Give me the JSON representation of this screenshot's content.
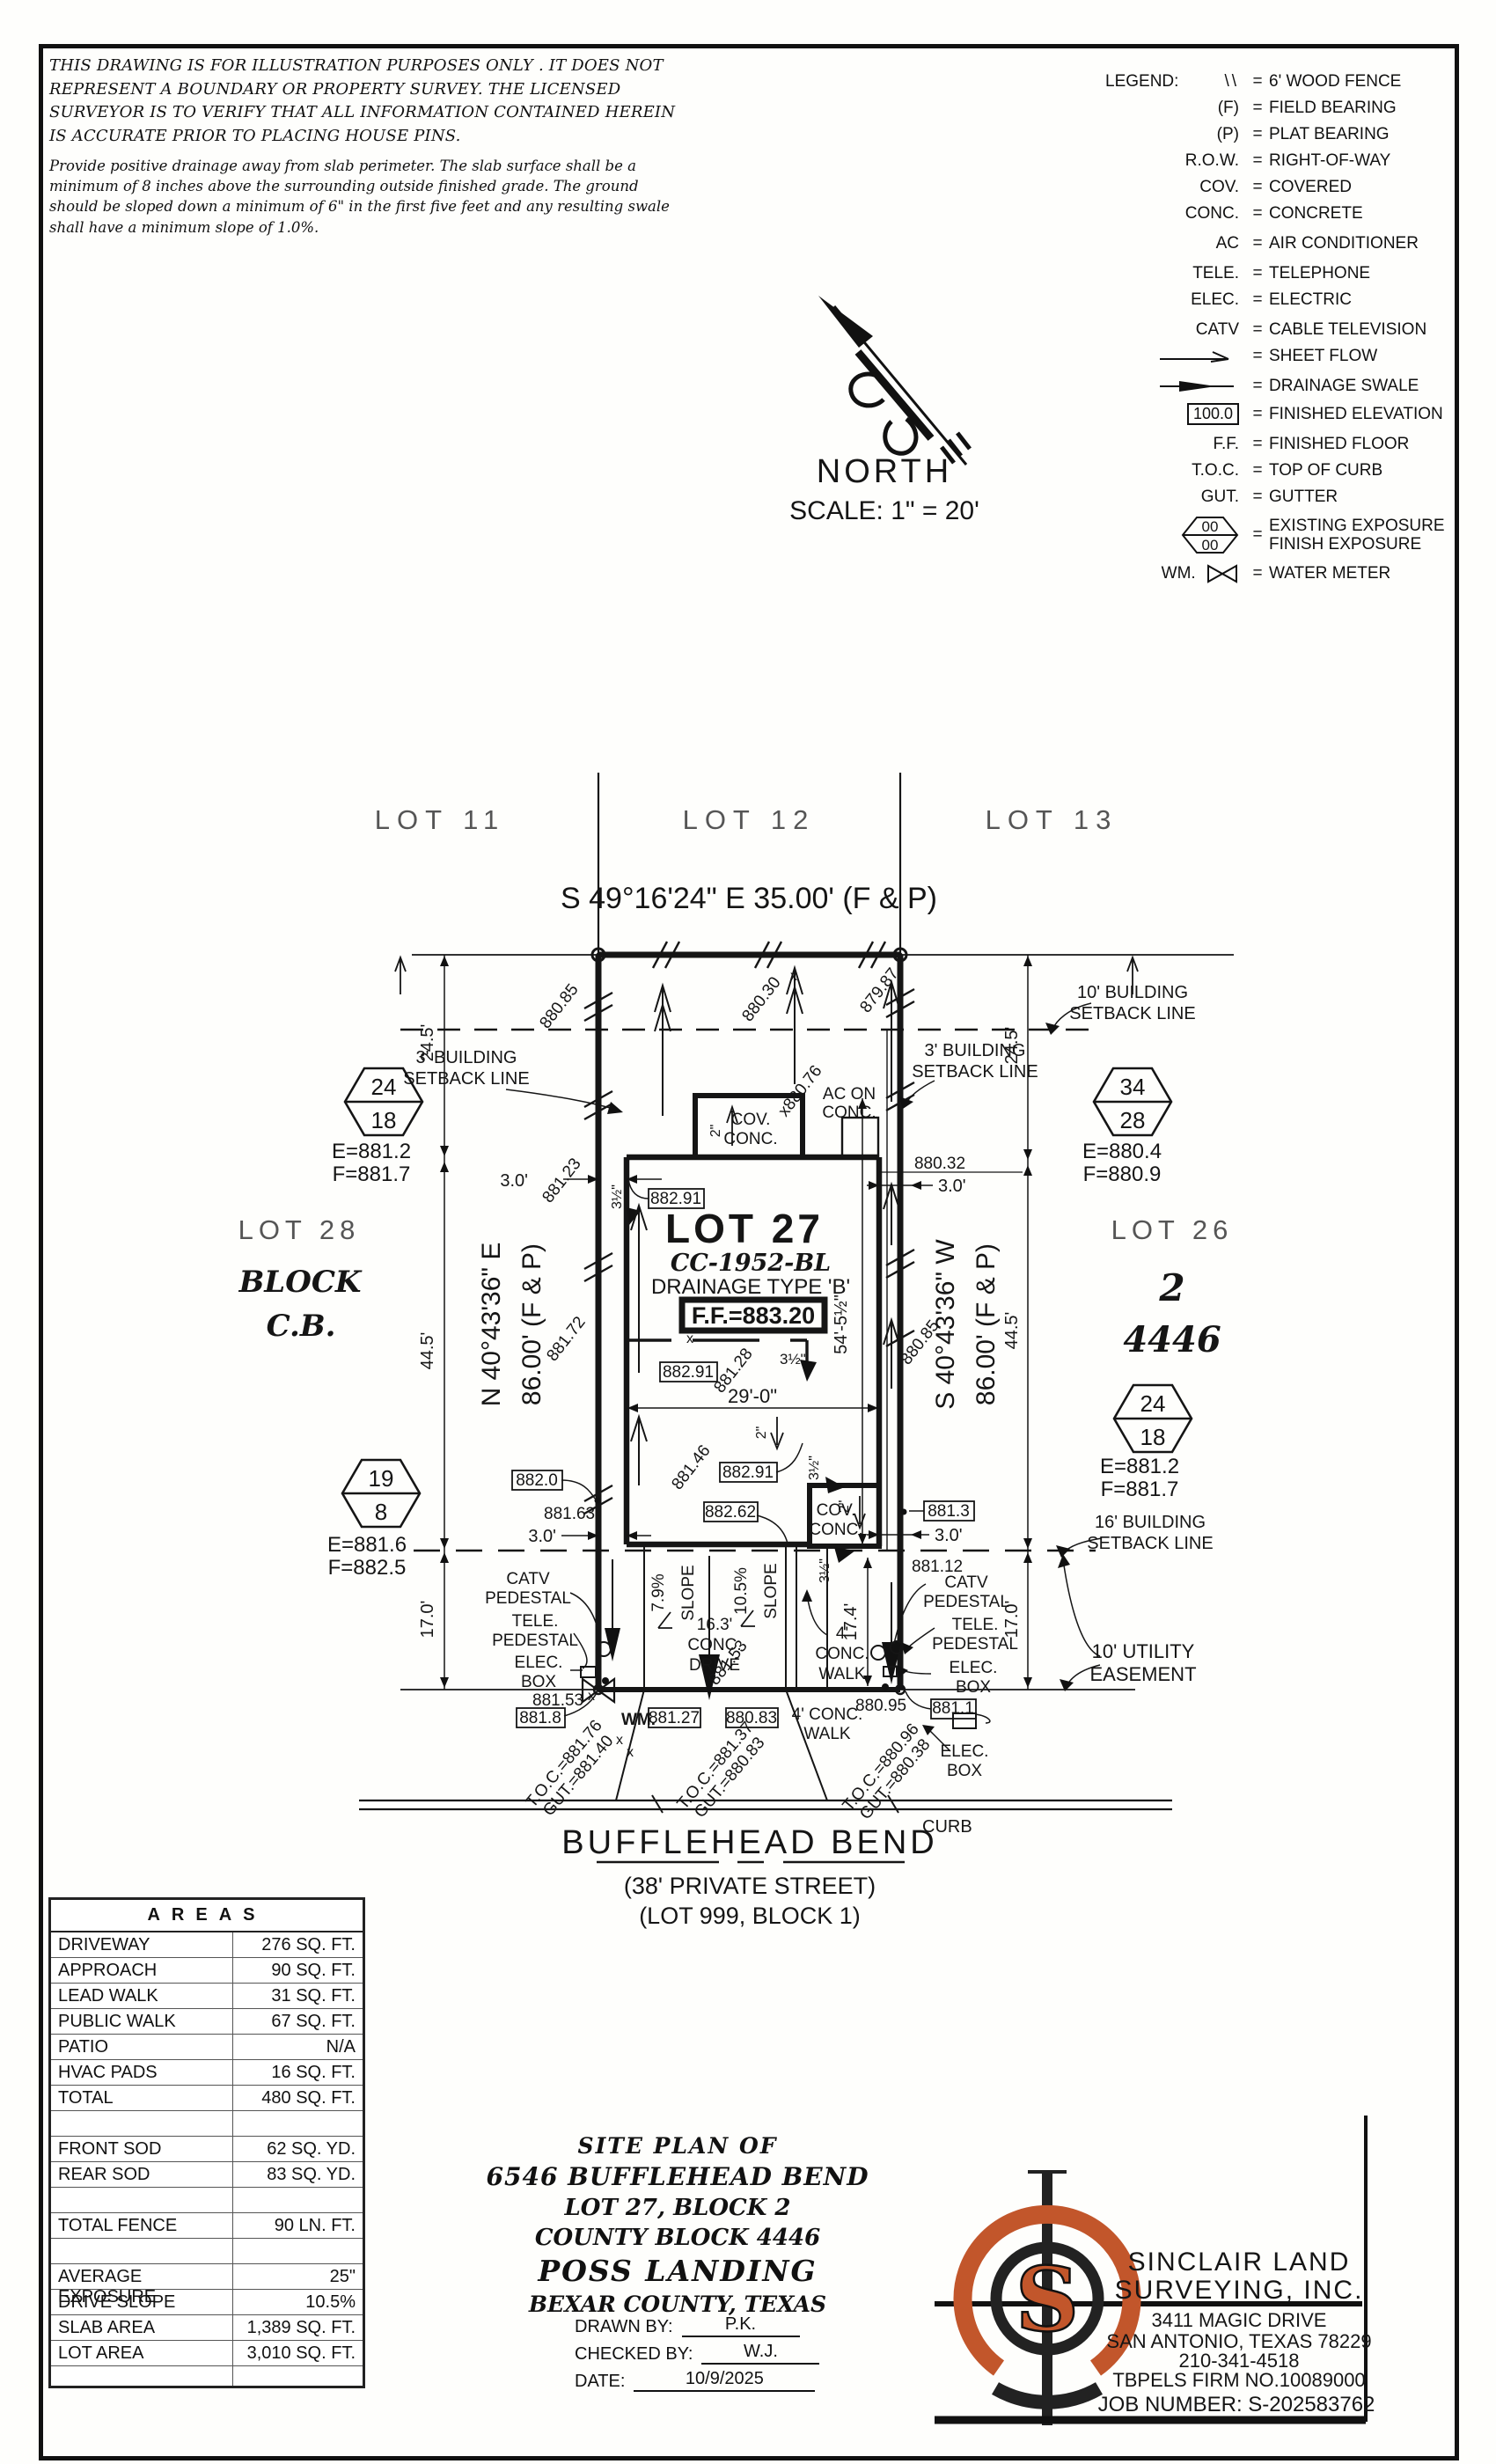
{
  "page": {
    "disclaimer1": "THIS DRAWING IS FOR ILLUSTRATION PURPOSES ONLY . IT DOES NOT REPRESENT A BOUNDARY OR PROPERTY SURVEY. THE LICENSED SURVEYOR IS TO VERIFY THAT ALL INFORMATION CONTAINED HEREIN IS ACCURATE PRIOR TO PLACING HOUSE PINS.",
    "disclaimer2": "Provide positive drainage away from slab perimeter. The slab surface shall be a minimum of 8 inches above the surrounding outside finished grade. The ground should be sloped down a minimum of 6\" in the first five feet and any resulting swale shall have a minimum slope of 1.0%."
  },
  "north": {
    "label": "NORTH",
    "scale": "SCALE: 1\" = 20'"
  },
  "legend": {
    "title": "LEGEND:",
    "eq": "=",
    "fence": {
      "sym": "\\\\",
      "txt": "6' WOOD FENCE"
    },
    "f": {
      "sym": "(F)",
      "txt": "FIELD BEARING"
    },
    "p": {
      "sym": "(P)",
      "txt": "PLAT BEARING"
    },
    "row": {
      "sym": "R.O.W.",
      "txt": "RIGHT-OF-WAY"
    },
    "cov": {
      "sym": "COV.",
      "txt": "COVERED"
    },
    "conc": {
      "sym": "CONC.",
      "txt": "CONCRETE"
    },
    "ac": {
      "sym": "AC",
      "txt": "AIR CONDITIONER"
    },
    "tele": {
      "sym": "TELE.",
      "txt": "TELEPHONE"
    },
    "elec": {
      "sym": "ELEC.",
      "txt": "ELECTRIC"
    },
    "catv": {
      "sym": "CATV",
      "txt": "CABLE TELEVISION"
    },
    "sheet": {
      "txt": "SHEET FLOW"
    },
    "swale": {
      "txt": "DRAINAGE SWALE"
    },
    "finelev": {
      "sym": "100.0",
      "txt": "FINISHED ELEVATION"
    },
    "ff": {
      "sym": "F.F.",
      "txt": "FINISHED FLOOR"
    },
    "toc": {
      "sym": "T.O.C.",
      "txt": "TOP OF CURB"
    },
    "gut": {
      "sym": "GUT.",
      "txt": "GUTTER"
    },
    "exposure": {
      "sym1": "00",
      "sym2": "00",
      "txt1": "EXISTING EXPOSURE",
      "txt2": "FINISH EXPOSURE"
    },
    "wm": {
      "sym": "WM.",
      "txt": "WATER METER"
    }
  },
  "plat": {
    "lots": {
      "l11": "LOT 11",
      "l12": "LOT 12",
      "l13": "LOT 13",
      "l26": "LOT 26",
      "l27": "LOT 27",
      "l28": "LOT 28"
    },
    "block_left": {
      "a": "BLOCK",
      "b": "C.B."
    },
    "block_right": {
      "a": "2",
      "b": "4446"
    },
    "parcel": {
      "cc": "CC-1952-BL",
      "drainage": "DRAINAGE TYPE 'B'",
      "ff": "F.F.=883.20"
    },
    "bearings": {
      "top": "S 49°16'24\" E 35.00' (F & P)",
      "left1": "N 40°43'36\" E",
      "right1": "S 40°43'36\" W",
      "dist": "86.00' (F & P)"
    },
    "hex": {
      "h24": "24",
      "h18": "18",
      "h34": "34",
      "h28": "28",
      "h19": "19",
      "h8": "8"
    },
    "ef": {
      "e8812": "E=881.2",
      "f8817": "F=881.7",
      "e8804": "E=880.4",
      "f8809": "F=880.9",
      "e8816": "E=881.6",
      "f8825": "F=882.5"
    },
    "setbacks": {
      "b10": "10' BUILDING",
      "b3": "3' BUILDING",
      "b16": "16' BUILDING",
      "line": "SETBACK LINE",
      "util1": "10' UTILITY",
      "util2": "EASEMENT"
    },
    "dims": {
      "d245": "24.5'",
      "d445": "44.5'",
      "d30": "3.0'",
      "d29": "29'-0\"",
      "d54": "54'-5½\"",
      "d17": "17.0'",
      "d174": "17.4'",
      "d163": "16.3'",
      "d4": "4'",
      "d4conc": "4' CONC.",
      "d2": "2\"",
      "d35": "3½\""
    },
    "words": {
      "cov": "COV.",
      "conc": "CONC.",
      "drive": "DRIVE",
      "walk": "WALK",
      "curb": "CURB",
      "wm": "WM.",
      "catv": "CATV",
      "tele": "TELE.",
      "elec": "ELEC.",
      "pedestal": "PEDESTAL",
      "box": "BOX",
      "ac1": "AC ON",
      "slope": "SLOPE",
      "p79": "7.9%",
      "p105": "10.5%",
      "x": "x"
    },
    "spots": {
      "s88085": "880.85",
      "s88030": "880.30",
      "s87987": "879.87",
      "s88123": "881.23",
      "s88172": "881.72",
      "s88032": "880.32",
      "s88076": "x880.76",
      "s88146": "881.46",
      "s88128": "881.28",
      "s88153": "881.53",
      "s88163": "881.63",
      "s88112": "881.12",
      "s88095": "880.95"
    },
    "boxed": {
      "b88291": "882.91",
      "b88262": "882.62",
      "b8820": "882.0",
      "b8813": "881.3",
      "b8818": "881.8",
      "b88127": "881.27",
      "b88083": "880.83",
      "b8811": "881.1"
    },
    "toc": {
      "t1": "T.O.C.=881.76",
      "g1": "GUT.=881.40",
      "t2": "T.O.C.=881.37",
      "g2": "GUT.=880.83",
      "t3": "T.O.C.=880.96",
      "g3": "GUT.=880.38"
    },
    "street": {
      "name": "BUFFLEHEAD BEND",
      "sub1": "(38' PRIVATE STREET)",
      "sub2": "(LOT 999, BLOCK 1)"
    }
  },
  "areas": {
    "title": "AREAS",
    "rows": [
      {
        "label": "DRIVEWAY",
        "value": "276 SQ. FT."
      },
      {
        "label": "APPROACH",
        "value": "90 SQ. FT."
      },
      {
        "label": "LEAD WALK",
        "value": "31 SQ. FT."
      },
      {
        "label": "PUBLIC WALK",
        "value": "67 SQ. FT."
      },
      {
        "label": "PATIO",
        "value": "N/A"
      },
      {
        "label": "HVAC PADS",
        "value": "16 SQ. FT."
      },
      {
        "label": "TOTAL",
        "value": "480 SQ. FT."
      },
      {
        "label": "",
        "value": ""
      },
      {
        "label": "FRONT SOD",
        "value": "62 SQ. YD."
      },
      {
        "label": "REAR SOD",
        "value": "83 SQ. YD."
      },
      {
        "label": "",
        "value": ""
      },
      {
        "label": "TOTAL FENCE",
        "value": "90 LN. FT."
      },
      {
        "label": "",
        "value": ""
      },
      {
        "label": "AVERAGE EXPOSURE",
        "value": "25\""
      },
      {
        "label": "DRIVE SLOPE",
        "value": "10.5%"
      },
      {
        "label": "SLAB AREA",
        "value": "1,389 SQ. FT."
      },
      {
        "label": "LOT AREA",
        "value": "3,010 SQ. FT."
      }
    ]
  },
  "titleblock": {
    "l1": "SITE PLAN OF",
    "l2": "6546 BUFFLEHEAD BEND",
    "l3": "LOT 27, BLOCK 2",
    "l4": "COUNTY BLOCK 4446",
    "l5": "POSS LANDING",
    "l6": "BEXAR COUNTY, TEXAS",
    "drawn_label": "DRAWN BY:",
    "drawn": "P.K.",
    "checked_label": "CHECKED BY:",
    "checked": "W.J.",
    "date_label": "DATE:",
    "date": "10/9/2025"
  },
  "company": {
    "name1": "SINCLAIR LAND",
    "name2": "SURVEYING, INC.",
    "addr1": "3411 MAGIC DRIVE",
    "addr2": "SAN ANTONIO, TEXAS 78229",
    "phone": "210-341-4518",
    "firm": "TBPELS FIRM NO.10089000",
    "job": "JOB NUMBER: S-202583762",
    "logo_letter": "S",
    "logo_orange": "#C2562B"
  }
}
